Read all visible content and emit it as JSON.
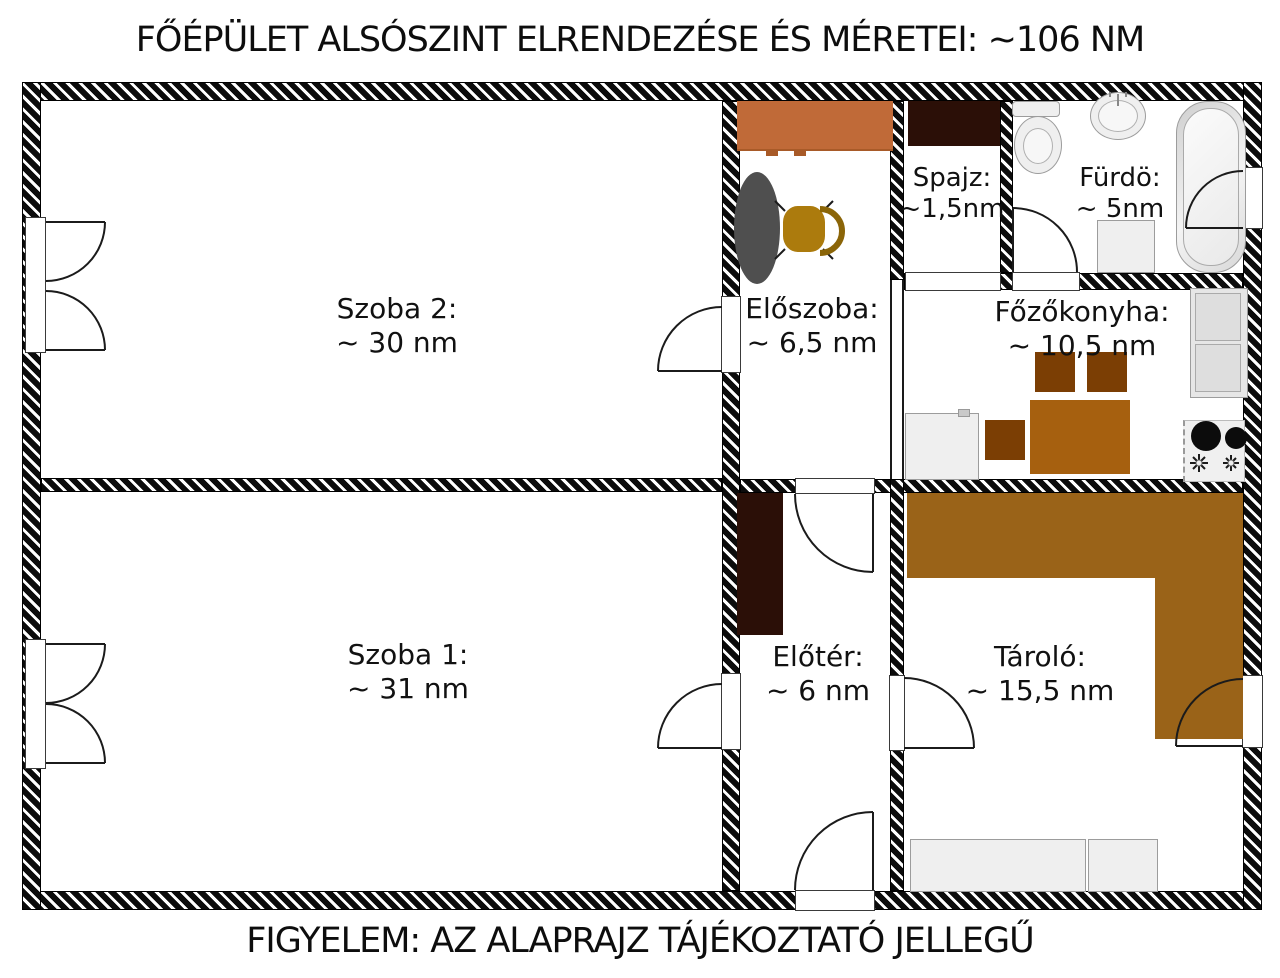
{
  "title": "FŐÉPÜLET ALSÓSZINT ELRENDEZÉSE ÉS MÉRETEI: ~106 NM",
  "footer": "FIGYELEM: AZ ALAPRAJZ TÁJÉKOZTATÓ JELLEGŰ",
  "total_area": "~106 NM",
  "rooms": {
    "szoba2": {
      "label": "Szoba 2:",
      "area": "~ 30 nm"
    },
    "szoba1": {
      "label": "Szoba 1:",
      "area": "~ 31 nm"
    },
    "eloszoba": {
      "label": "Előszoba:",
      "area": "~ 6,5 nm"
    },
    "spajz": {
      "label": "Spajz:",
      "area": "~1,5nm"
    },
    "furdo": {
      "label": "Fürdö:",
      "area": "~ 5nm"
    },
    "fozokonyha": {
      "label": "Főzőkonyha:",
      "area": "~ 10,5 nm"
    },
    "eloter": {
      "label": "Előtér:",
      "area": "~ 6 nm"
    },
    "tarolo": {
      "label": "Tároló:",
      "area": "~ 15,5 nm"
    }
  },
  "colors": {
    "wall": "#0c0c0c",
    "orange_cabinet": "#c06a38",
    "dark_cabinet": "#2b0f07",
    "kitchen_table": "#a6600f",
    "kitchen_chair": "#7b3e04",
    "storage_counter": "#9a6318",
    "gold_chair": "#ac7b0d",
    "gray_table": "#4f4f4f",
    "appliance": "#efefef"
  }
}
